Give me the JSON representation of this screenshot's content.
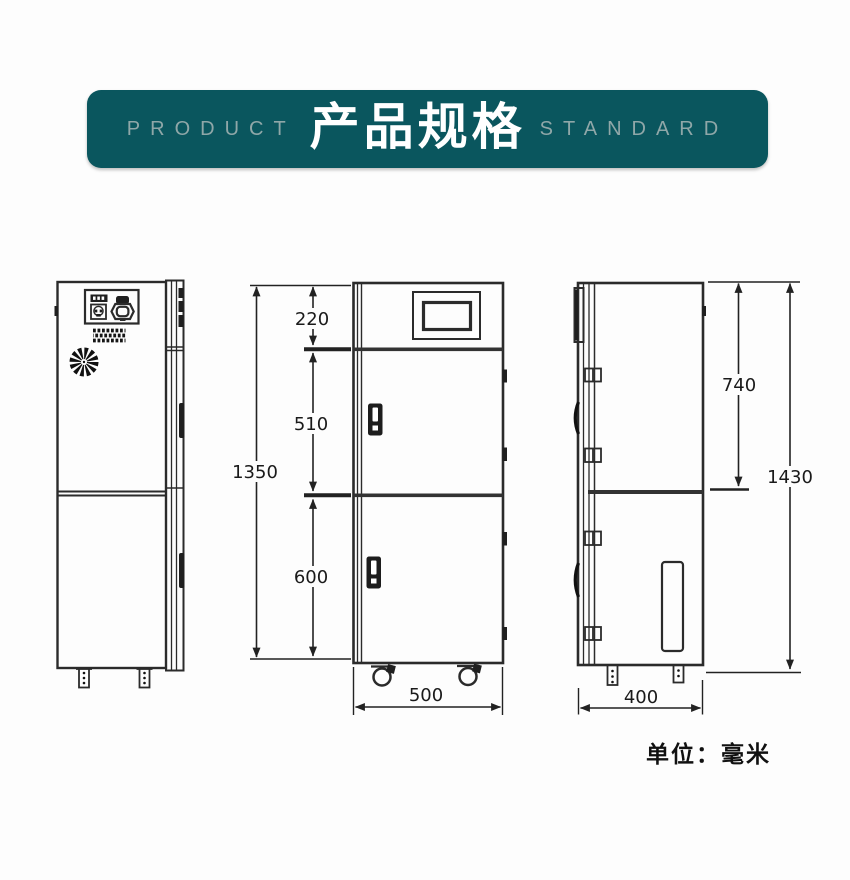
{
  "header": {
    "left_label": "PRODUCT",
    "title": "产品规格",
    "right_label": "STANDARD",
    "banner_color": "#0a565e",
    "side_text_color": "#8fa7a8"
  },
  "drawing": {
    "line_color": "#2b2b2b",
    "unit_note": "单位：毫米",
    "views": {
      "left": "rear-view",
      "middle": "front-view",
      "right": "side-view"
    },
    "dimensions": {
      "front_top_height": "220",
      "front_upper_door_height": "510",
      "front_lower_door_height": "600",
      "front_total_height": "1350",
      "front_width": "500",
      "side_upper_height": "740",
      "side_total_height": "1430",
      "side_depth": "400"
    }
  }
}
